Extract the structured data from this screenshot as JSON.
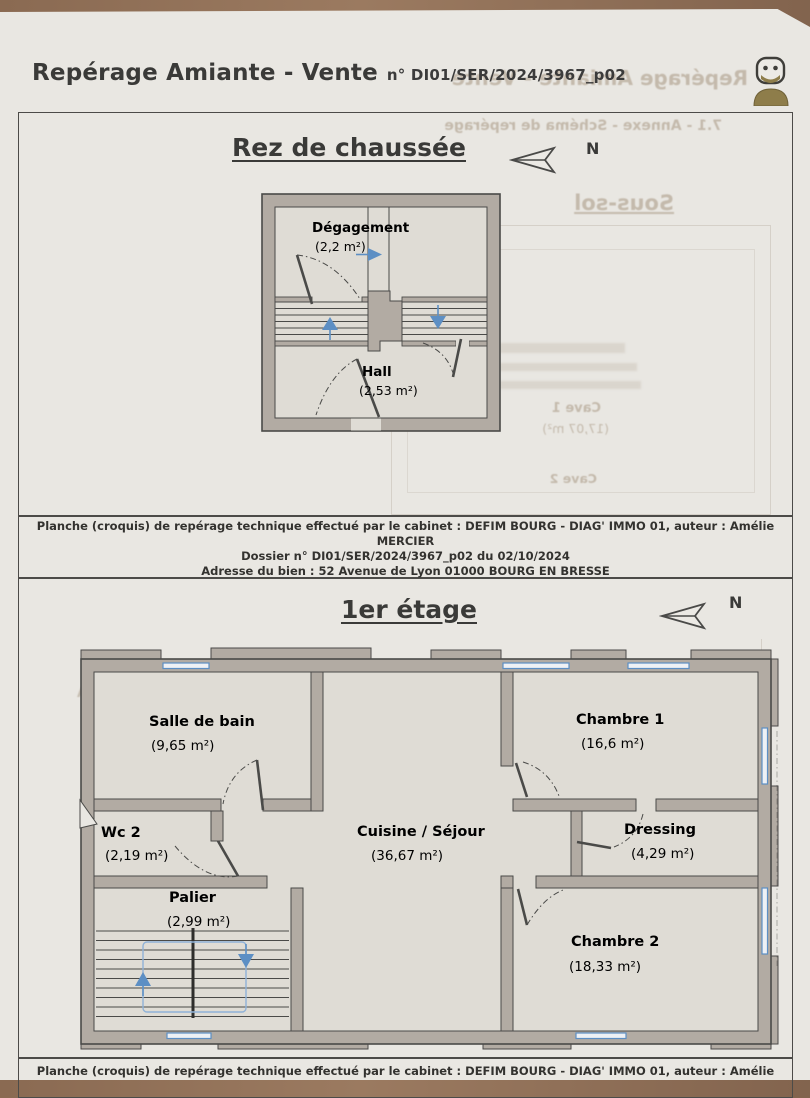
{
  "header": {
    "title": "Repérage Amiante - Vente",
    "doc_number": "n° DI01/SER/2024/3967_p02"
  },
  "ground_floor": {
    "title": "Rez de chaussée",
    "north_label": "N",
    "rooms": {
      "degagement": {
        "name": "Dégagement",
        "area": "(2,2 m²)"
      },
      "hall": {
        "name": "Hall",
        "area": "(2,53 m²)"
      }
    }
  },
  "first_floor": {
    "title": "1er étage",
    "north_label": "N",
    "rooms": {
      "salle_de_bain": {
        "name": "Salle de bain",
        "area": "(9,65 m²)"
      },
      "chambre1": {
        "name": "Chambre 1",
        "area": "(16,6 m²)"
      },
      "wc2": {
        "name": "Wc 2",
        "area": "(2,19 m²)"
      },
      "cuisine": {
        "name": "Cuisine / Séjour",
        "area": "(36,67 m²)"
      },
      "dressing": {
        "name": "Dressing",
        "area": "(4,29 m²)"
      },
      "palier": {
        "name": "Palier",
        "area": "(2,99 m²)"
      },
      "chambre2": {
        "name": "Chambre 2",
        "area": "(18,33 m²)"
      }
    }
  },
  "caption": {
    "line1": "Planche (croquis) de repérage technique effectué par le cabinet : DEFIM BOURG - DIAG' IMMO 01, auteur : Amélie",
    "line2": "MERCIER",
    "line3": "Dossier n° DI01/SER/2024/3967_p02 du 02/10/2024",
    "line4": "Adresse du bien : 52 Avenue de Lyon  01000 BOURG EN BRESSE"
  },
  "bleedthrough": {
    "header_echo": "Repérage Amiante - Vente",
    "annex_71": "7.1 - Annexe - Schéma de repérage",
    "annex_72": "7.2 - Annexe - Rapport d'essais",
    "no_photo": "Aucune photo d'illustration n'a été jointe à ce rapport",
    "basement_title": "Sous-sol",
    "wc1": "Wc 1",
    "cave1": "Cave 1",
    "cave1_area": "(17,07 m²)",
    "cave2": "Cave 2"
  },
  "colors": {
    "wall_fill": "#b2aba3",
    "outline": "#4a4a48",
    "floor": "#dfdcd5",
    "paper": "#e9e7e2",
    "blue": "#5d8fc4",
    "desk": "#8a6a52",
    "logo_olive": "#8e7d4a"
  }
}
